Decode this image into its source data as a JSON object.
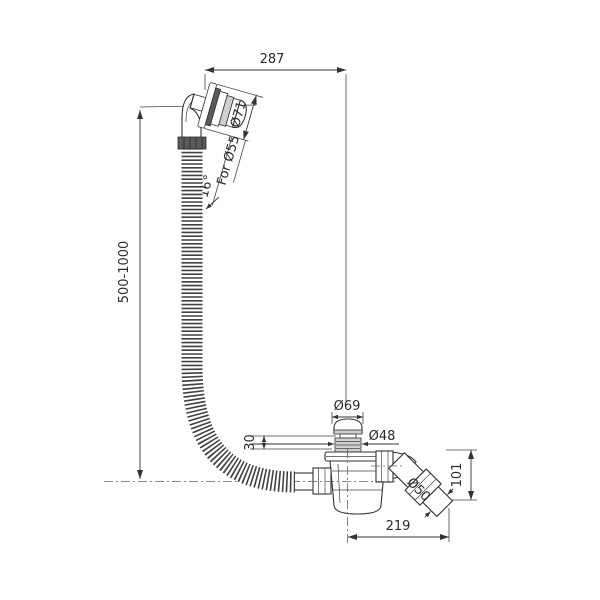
{
  "drawing": {
    "type": "technical-drawing",
    "subject": "bath-waste-overflow-kit",
    "colors": {
      "background": "#ffffff",
      "line": "#333333",
      "centerline": "#666666"
    },
    "dims": {
      "top_width": "287",
      "overflow_flange_diameter": "Ø71",
      "overflow_hole": "For Ø55",
      "head_angle": "16°",
      "hose_length_range": "500-1000",
      "cap_diameter": "Ø69",
      "waste_plug_diameter": "Ø48",
      "popup_height": "30",
      "outlet_pipe_diameter": "Ø50",
      "outlet_height": "101",
      "bottom_width": "219"
    }
  }
}
